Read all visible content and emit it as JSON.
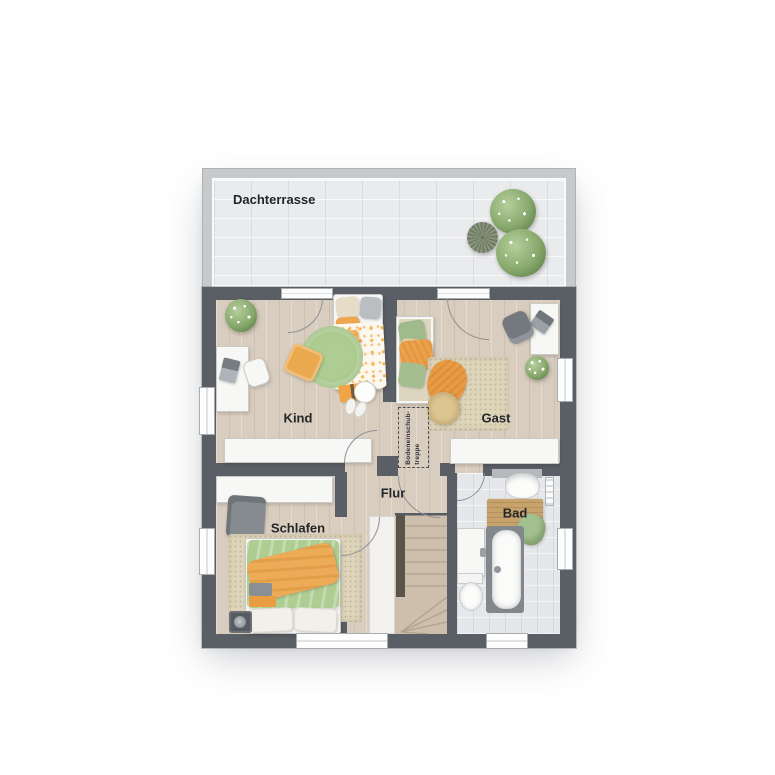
{
  "floor_plan": {
    "rooms": {
      "dachterrasse": {
        "label": "Dachterrasse"
      },
      "kind": {
        "label": "Kind"
      },
      "gast": {
        "label": "Gast"
      },
      "flur": {
        "label": "Flur"
      },
      "schlafen": {
        "label": "Schlafen"
      },
      "bad": {
        "label": "Bad"
      },
      "attic_hatch": {
        "label_line1": "Bodeneinschub-",
        "label_line2": "treppe"
      }
    },
    "colors": {
      "wall": "#5a5f65",
      "terrace_wall": "#c7cacd",
      "wood_floor": "#d9cdbf",
      "terrace_tile": "#eaebed",
      "bath_tile": "#e5e7ea",
      "furniture_white": "#f7f7f5",
      "accent_orange": "#eda64e",
      "accent_green": "#aecd92",
      "rug_beige": "#ded4ba",
      "stair_wood": "#cdbfab"
    }
  }
}
